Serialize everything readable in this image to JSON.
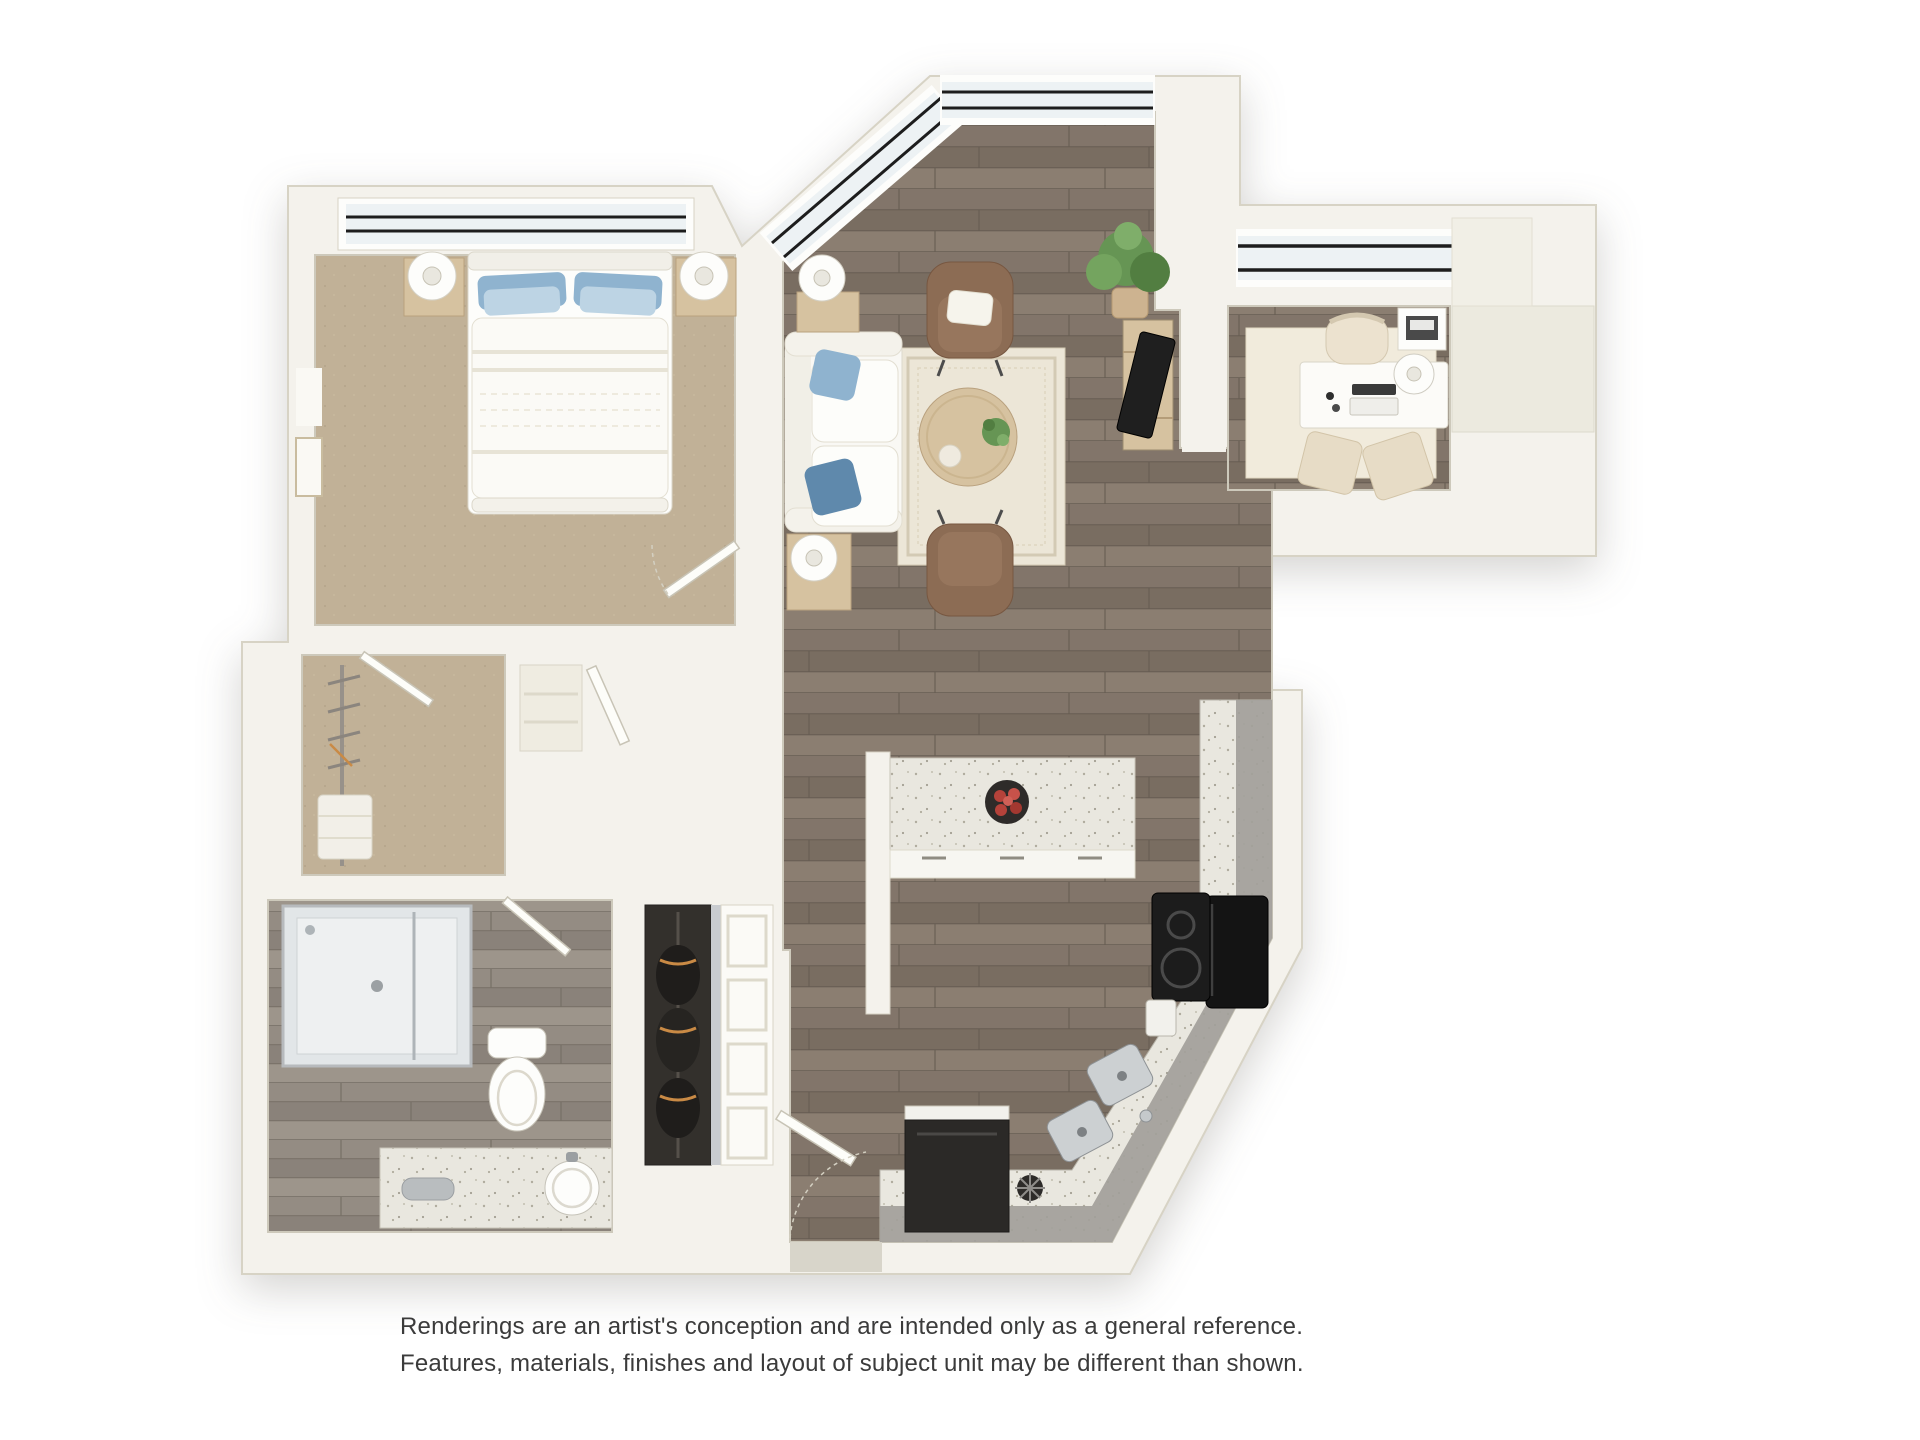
{
  "disclaimer": {
    "line1": "Renderings are an artist's conception and are intended only as a general reference.",
    "line2": "Features, materials, finishes and layout of subject unit may be different than shown."
  },
  "palette": {
    "wall": "#f4f2ec",
    "wallEdge": "#d7d3c5",
    "wallShade": "#eceadf",
    "woodR1": "#82756a",
    "woodR2": "#796d61",
    "woodR3": "#8b7e71",
    "woodSeam": "#665c52",
    "bathR1": "#948c83",
    "bathR2": "#8a827a",
    "bathR3": "#9d958b",
    "bathSeam": "#776f66",
    "carpet": "#c1b197",
    "carpetDot": "#b0a086",
    "glass": "#edf2f4",
    "mullion": "#1d1d1d",
    "frame": "#fdfdfb",
    "counter": "#e9e7df",
    "cabinetGray": "#a2a09a",
    "appliance": "#2b2927",
    "steel": "#ccd0d2",
    "steelDark": "#8e9295",
    "rug": "#ece6d7",
    "rugBorder": "#d3cab4",
    "denRug": "#f1ebdc",
    "furnWood": "#d6c2a0",
    "furnWoodEdge": "#b9a17e",
    "sofa": "#f9f8f4",
    "cushionEdge": "#e2ded1",
    "pBlue": "#8fb3cf",
    "pBlueDk": "#5f89ac",
    "pBlueLt": "#bdd4e4",
    "chairBrown": "#8c6c54",
    "chairBrownDk": "#775741",
    "green": "#669554",
    "greenDk": "#527e41",
    "pot": "#cdb390",
    "white": "#fdfdfb",
    "ink": "#3b3b3b",
    "apple": "#b5423a",
    "bowl": "#2e2b29"
  },
  "floorplan": {
    "type": "3d-rendered-apartment-floor-plan",
    "rooms": [
      {
        "name": "bedroom",
        "floor": "carpet",
        "furniture": [
          "queen-bed",
          "blue-pillows",
          "nightstand-left",
          "nightstand-right",
          "table-lamps",
          "framed-art",
          "clerestory-window"
        ]
      },
      {
        "name": "walk-in-closet",
        "floor": "carpet",
        "furniture": [
          "clothes-rod",
          "hangers",
          "folded-linens"
        ]
      },
      {
        "name": "living-room",
        "floor": "hardwood",
        "furniture": [
          "tufted-sofa",
          "area-rug",
          "round-coffee-table",
          "potted-plant",
          "accent-chair-top",
          "accent-chair-bottom",
          "side-tables",
          "floor-lamps",
          "media-console",
          "tv",
          "corner-plant",
          "prow-clerestory-windows"
        ]
      },
      {
        "name": "den-office",
        "floor": "hardwood",
        "furniture": [
          "desk",
          "desk-chair",
          "laptop",
          "printer-stand",
          "desk-lamp",
          "ottoman-cubes",
          "area-rug",
          "clerestory-window"
        ]
      },
      {
        "name": "kitchen",
        "floor": "hardwood",
        "furniture": [
          "peninsula-counter",
          "fruit-bowl",
          "base-cabinets",
          "cooktop-range",
          "toaster",
          "double-sink",
          "dishwasher",
          "angled-counter"
        ]
      },
      {
        "name": "bathroom",
        "floor": "tile",
        "furniture": [
          "glass-shower",
          "toilet",
          "vanity-counter",
          "round-sink",
          "towel"
        ]
      },
      {
        "name": "entry-hall",
        "floor": "hardwood",
        "furniture": [
          "entry-door",
          "wardrobe-closet",
          "paneled-closet-doors",
          "linen-closet"
        ]
      }
    ]
  }
}
